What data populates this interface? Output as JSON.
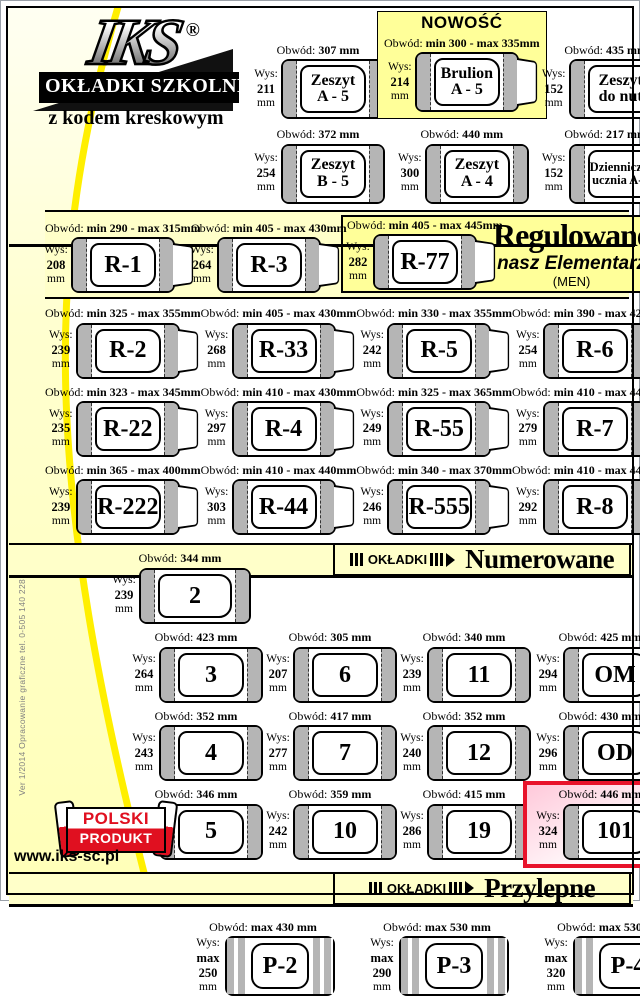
{
  "labels": {
    "obwod": "Obwód:",
    "wys": "Wys:",
    "unit": "mm"
  },
  "logo": {
    "brand": "IKS",
    "reg": "®",
    "banner": "OKŁADKI SZKOLNE",
    "tagline": "z kodem kreskowym"
  },
  "top": {
    "items": [
      {
        "label": "Zeszyt\nA - 5",
        "obwod": "307 mm",
        "wys": "211"
      },
      {
        "label": "Brulion\nA - 5",
        "obwod": "min 300 - max 335mm",
        "wys": "214",
        "badge": "NOWOŚĆ",
        "variant": "nowosc flap"
      },
      {
        "label": "Zeszyt\ndo nut",
        "obwod": "435 mm",
        "wys": "152"
      },
      {
        "label": "Zeszyt\nB - 5",
        "obwod": "372 mm",
        "wys": "254"
      },
      {
        "label": "Zeszyt\nA - 4",
        "obwod": "440 mm",
        "wys": "300"
      },
      {
        "label": "Dzienniczek\nucznia A- 6",
        "obwod": "217 mm",
        "wys": "152",
        "variant": "small"
      }
    ]
  },
  "regulowane": {
    "title": "Regulowane",
    "subtitle": "nasz Elementarz",
    "subtitle2": "(MEN)",
    "row1": [
      {
        "label": "R-1",
        "obwod": "min 290 - max 315mm",
        "wys": "208",
        "variant": "flap"
      },
      {
        "label": "R-3",
        "obwod": "min 405 - max 430mm",
        "wys": "264",
        "variant": "flap"
      }
    ],
    "featured": [
      {
        "label": "R-77",
        "obwod": "min 405 - max 445mm",
        "wys": "282",
        "variant": "flap"
      }
    ],
    "grid": [
      {
        "label": "R-2",
        "obwod": "min 325 - max 355mm",
        "wys": "239",
        "variant": "flap"
      },
      {
        "label": "R-33",
        "obwod": "min 405 - max 430mm",
        "wys": "268",
        "variant": "flap"
      },
      {
        "label": "R-5",
        "obwod": "min 330 - max 355mm",
        "wys": "242",
        "variant": "flap"
      },
      {
        "label": "R-6",
        "obwod": "min 390 - max 420mm",
        "wys": "254",
        "variant": "flap"
      },
      {
        "label": "R-22",
        "obwod": "min 323 - max 345mm",
        "wys": "235",
        "variant": "flap"
      },
      {
        "label": "R-4",
        "obwod": "min 410 - max 430mm",
        "wys": "297",
        "variant": "flap"
      },
      {
        "label": "R-55",
        "obwod": "min 325 - max 365mm",
        "wys": "249",
        "variant": "flap"
      },
      {
        "label": "R-7",
        "obwod": "min 410 - max 445mm",
        "wys": "279",
        "variant": "flap"
      },
      {
        "label": "R-222",
        "obwod": "min 365 - max 400mm",
        "wys": "239",
        "variant": "flap"
      },
      {
        "label": "R-44",
        "obwod": "min 410 - max 440mm",
        "wys": "303",
        "variant": "flap"
      },
      {
        "label": "R-555",
        "obwod": "min 340 - max 370mm",
        "wys": "246",
        "variant": "flap"
      },
      {
        "label": "R-8",
        "obwod": "min 410 - max 440mm",
        "wys": "292",
        "variant": "flap"
      }
    ]
  },
  "numerowane": {
    "badge": "OKŁADKI",
    "title": "Numerowane",
    "row1": [
      {
        "label": "2",
        "obwod": "344 mm",
        "wys": "239"
      }
    ],
    "grid": [
      {
        "label": "3",
        "obwod": "423 mm",
        "wys": "264"
      },
      {
        "label": "6",
        "obwod": "305 mm",
        "wys": "207"
      },
      {
        "label": "11",
        "obwod": "340 mm",
        "wys": "239"
      },
      {
        "label": "OM",
        "obwod": "425 mm",
        "wys": "294"
      },
      {
        "label": "4",
        "obwod": "352 mm",
        "wys": "243"
      },
      {
        "label": "7",
        "obwod": "417 mm",
        "wys": "277"
      },
      {
        "label": "12",
        "obwod": "352 mm",
        "wys": "240"
      },
      {
        "label": "OD",
        "obwod": "430 mm",
        "wys": "296"
      },
      {
        "label": "5",
        "obwod": "346 mm",
        "wys": "241"
      },
      {
        "label": "10",
        "obwod": "359 mm",
        "wys": "242"
      },
      {
        "label": "19",
        "obwod": "415 mm",
        "wys": "286"
      },
      {
        "label": "101",
        "obwod": "446 mm",
        "wys": "324",
        "variant": "hl-red"
      }
    ]
  },
  "przylepne": {
    "badge": "OKŁADKI",
    "title": "Przylepne",
    "items": [
      {
        "label": "P-2",
        "obwod": "max 430 mm",
        "wys": "max\n250",
        "variant": "double"
      },
      {
        "label": "P-3",
        "obwod": "max 530 mm",
        "wys": "max\n290",
        "variant": "double"
      },
      {
        "label": "P-4",
        "obwod": "max 530 mm",
        "wys": "max\n320",
        "variant": "double"
      }
    ]
  },
  "footer": {
    "polski": "POLSKI",
    "produkt": "PRODUKT",
    "website": "www.iks-sc.pl",
    "side_note": "Ver 1/2014 Opracowanie graficzne  tel. 0-505 140 228"
  }
}
